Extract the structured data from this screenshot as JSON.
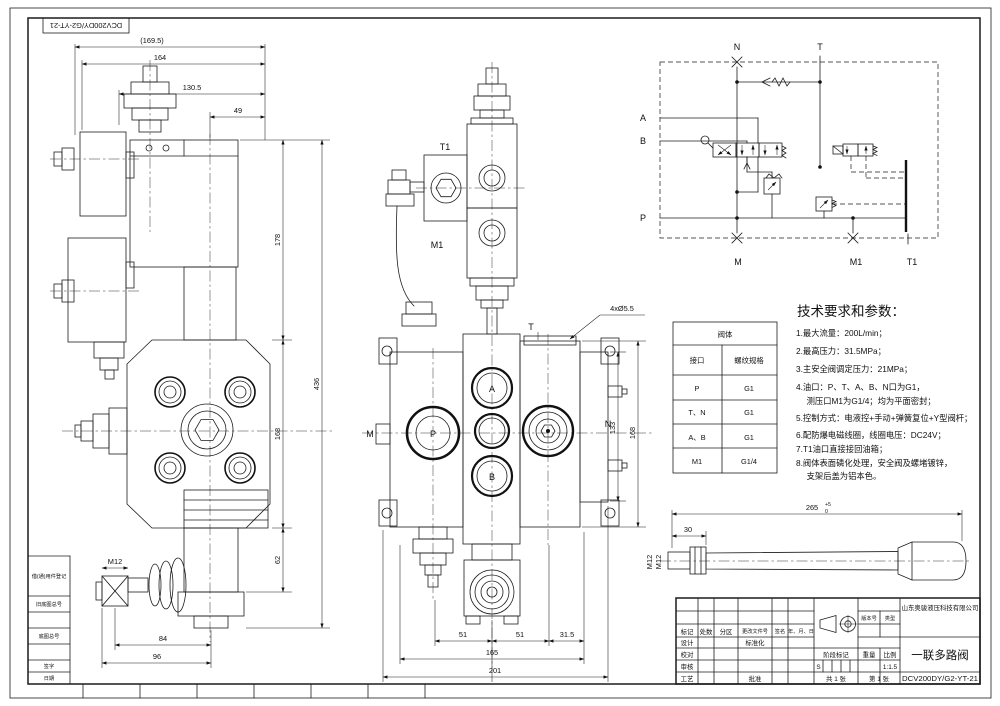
{
  "sheet": {
    "corner_stamp": "DCV200DY/G2-YT-21"
  },
  "side_view": {
    "dims": {
      "overall_width_ref": "(169.5)",
      "width_164": "164",
      "width_130_5": "130.5",
      "width_49": "49",
      "height_178": "178",
      "height_436": "436",
      "height_168": "168",
      "height_62": "62",
      "width_84": "84",
      "width_96": "96",
      "thread_m12": "M12"
    }
  },
  "front_view": {
    "port_labels": {
      "t1": "T1",
      "m1": "M1",
      "m": "M",
      "n": "N",
      "t": "T",
      "a": "A",
      "b": "B",
      "p": "P"
    },
    "notes": {
      "holes": "4xØ5.5",
      "thread_m12": "M12"
    },
    "dims": {
      "pitch_51_left": "51",
      "pitch_51_right": "51",
      "offset_31_5": "31.5",
      "width_165": "165",
      "width_201": "201",
      "height_133": "133",
      "height_168": "168"
    }
  },
  "schematic": {
    "port_labels": {
      "n": "N",
      "t": "T",
      "a": "A",
      "b": "B",
      "p": "P",
      "m": "M",
      "m1": "M1",
      "t1": "T1"
    }
  },
  "port_table": {
    "title": "阀体",
    "col_port": "接口",
    "col_thread": "螺纹规格",
    "rows": [
      {
        "port": "P",
        "thread": "G1"
      },
      {
        "port": "T、N",
        "thread": "G1"
      },
      {
        "port": "A、B",
        "thread": "G1"
      },
      {
        "port": "M1",
        "thread": "G1/4"
      }
    ]
  },
  "tech_notes": {
    "title": "技术要求和参数：",
    "lines": [
      "1.最大流量：200L/min；",
      "2.最高压力：31.5MPa；",
      "3.主安全阀调定压力：21MPa；",
      "4.油口：P、T、A、B、N口为G1，",
      "　 测压口M1为G1/4；均为平面密封；",
      "5.控制方式：电液控+手动+弹簧复位+Y型阀杆；",
      "6.配防爆电磁线圈，线圈电压：DC24V；",
      "7.T1油口直接接回油箱；",
      "8.阀体表面磷化处理，安全阀及螺堵镀锌，",
      "　 支架后盖为铝本色。"
    ]
  },
  "handle_view": {
    "dims": {
      "length_265": "265",
      "tol_upper": "+5",
      "tol_lower": "0",
      "length_30": "30",
      "thread_m12": "M12"
    }
  },
  "title_block": {
    "company": "山东奥骏液压科技有限公司",
    "product_name": "一联多路阀",
    "drawing_number": "DCV200DY/G2-YT-21",
    "scale_value": "1:1.5",
    "stage_s": "S",
    "sheets_total": "共 1 张",
    "sheet_no": "第 1 张",
    "labels": {
      "mark": "标记",
      "qty": "处数",
      "zone": "分区",
      "change_doc": "更改文件号",
      "sign": "签名",
      "date": "年、月、日",
      "design": "设计",
      "proof": "校对",
      "audit": "审核",
      "craft": "工艺",
      "standardization": "标准化",
      "approval": "批准",
      "stage_mark": "阶段标记",
      "weight": "重量",
      "scale_label": "比例",
      "version_no": "版本号",
      "type": "类型"
    }
  },
  "margin_block": {
    "rows": [
      "借(通)用件登记",
      "旧底图总号",
      "底图总号",
      "签字",
      "日期"
    ]
  }
}
